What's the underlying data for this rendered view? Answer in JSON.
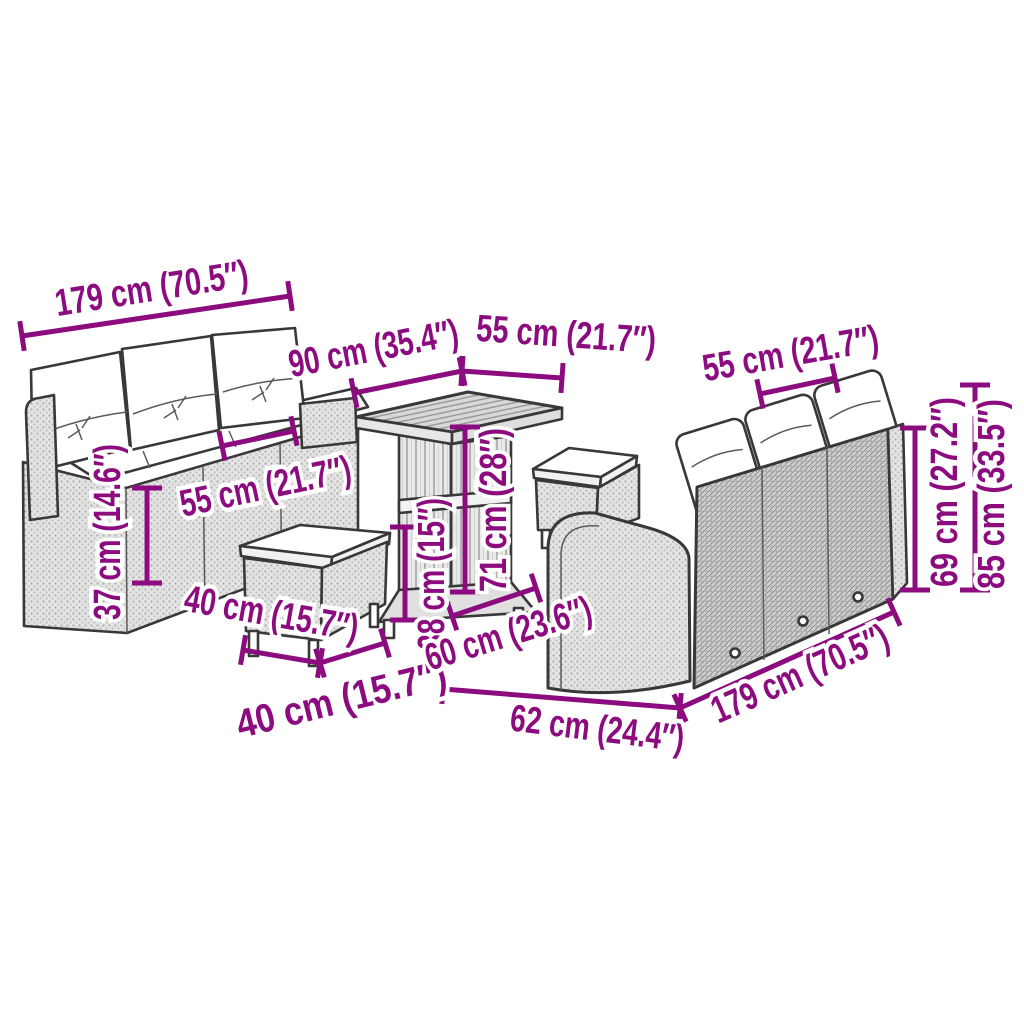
{
  "diagram": {
    "description": "Dimension diagram of a poly rattan garden lounge set: two 3-seater sofas with cushions, a square table and two footstools",
    "accent_color": "#8C0C80",
    "background_color": "#FFFFFF",
    "objects": [
      "three-seater-sofa-left",
      "footstool-front",
      "square-table",
      "footstool-back",
      "three-seater-sofa-right"
    ],
    "measurements": {
      "left_sofa_width": "179 cm (70.5″)",
      "table_width": "90 cm (35.4″)",
      "table_depth": "55 cm (21.7″)",
      "right_sofa_back_depth": "55 cm (21.7″)",
      "left_sofa_seat_depth": "55 cm (21.7″)",
      "left_sofa_seat_height": "37 cm (14.6″)",
      "stool_width": "40 cm (15.7″)",
      "stool_depth": "40 cm (15.7″)",
      "table_shelf_height": "38 cm (15″)",
      "table_height": "71 cm (28″)",
      "right_sofa_seat_depth": "60 cm (23.6″)",
      "right_sofa_arm_depth": "62 cm (24.4″)",
      "right_sofa_width": "179 cm (70.5″)",
      "right_sofa_back_height": "69 cm (27.2″)",
      "right_sofa_total_height": "85 cm (33.5″)"
    }
  }
}
